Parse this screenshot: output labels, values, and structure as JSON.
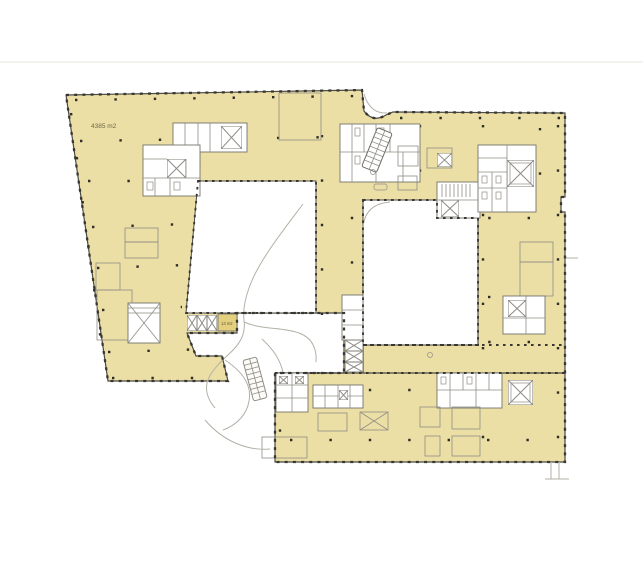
{
  "plan": {
    "labels": {
      "main_area": "4385 m2",
      "small_area": "13 m2"
    },
    "colors": {
      "background": "#ffffff",
      "floor_fill": "#ecdfa5",
      "small_room_fill": "#e4cf7e",
      "outline": "#4b4a43",
      "partition": "#8f8d85",
      "landscape_path": "#b3b1a6",
      "column_dot": "#2e2d28"
    }
  }
}
